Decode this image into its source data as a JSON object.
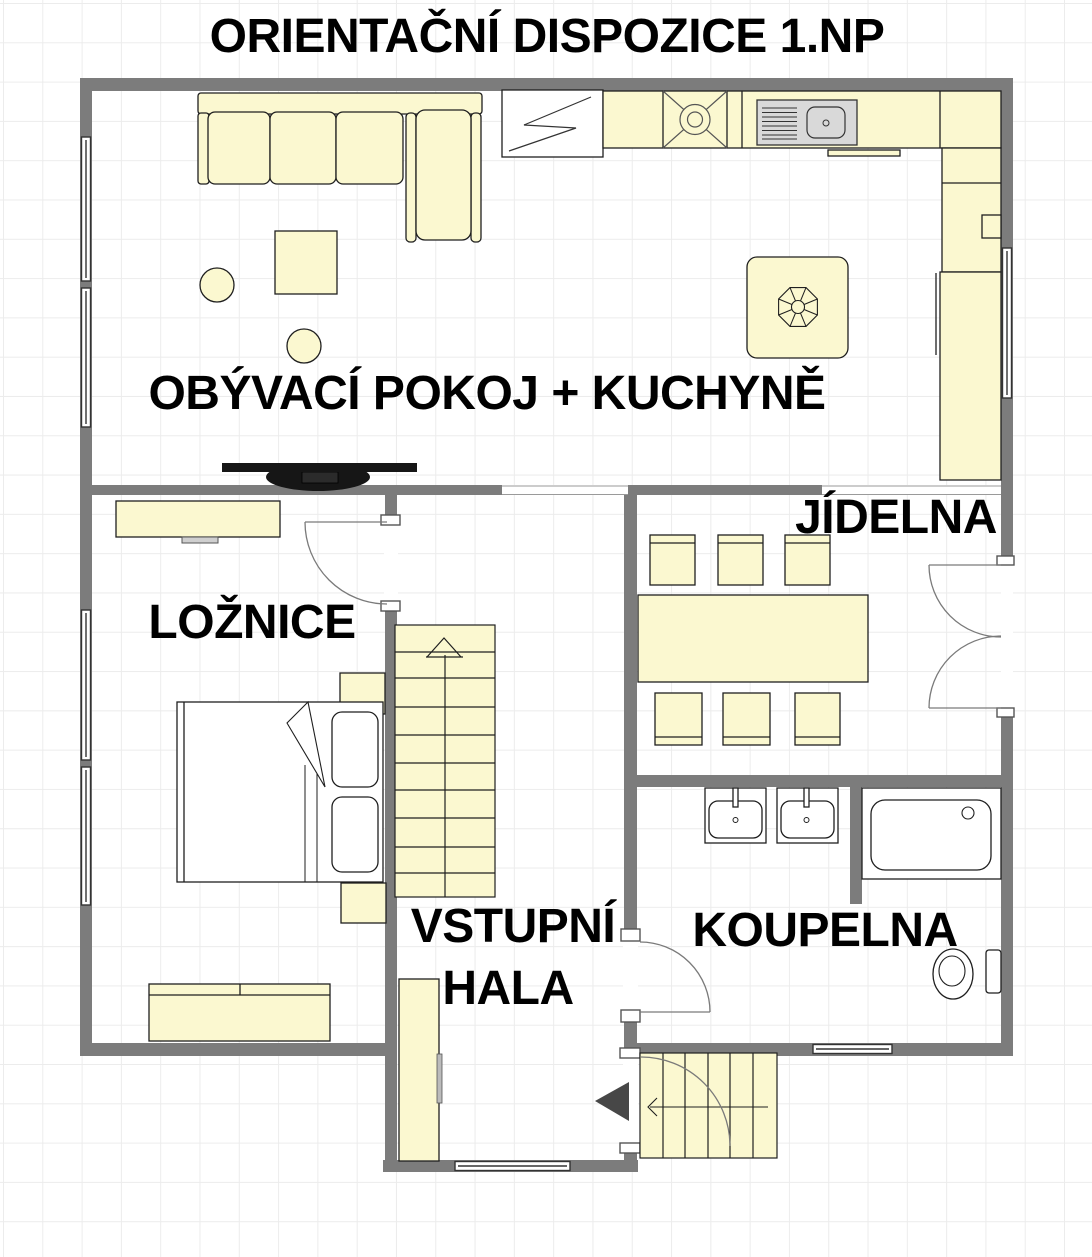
{
  "title": "ORIENTAČNÍ DISPOZICE 1.NP",
  "rooms": {
    "living_kitchen": {
      "label": "OBÝVACÍ POKOJ + KUCHYNĚ"
    },
    "bedroom": {
      "label": "LOŽNICE"
    },
    "dining": {
      "label": "JÍDELNA"
    },
    "hall": {
      "label_line1": "VSTUPNÍ",
      "label_line2": "HALA"
    },
    "bathroom": {
      "label": "KOUPELNA"
    }
  },
  "colors": {
    "wall": "#7C7C7C",
    "furniture_fill": "#FBF8D0",
    "outline": "#1F1F1F",
    "sink_gray": "#D9D9D9",
    "tv_black": "#161616",
    "grid_line": "#ECECEC",
    "background": "#FFFFFF",
    "label_text": "#000000"
  }
}
